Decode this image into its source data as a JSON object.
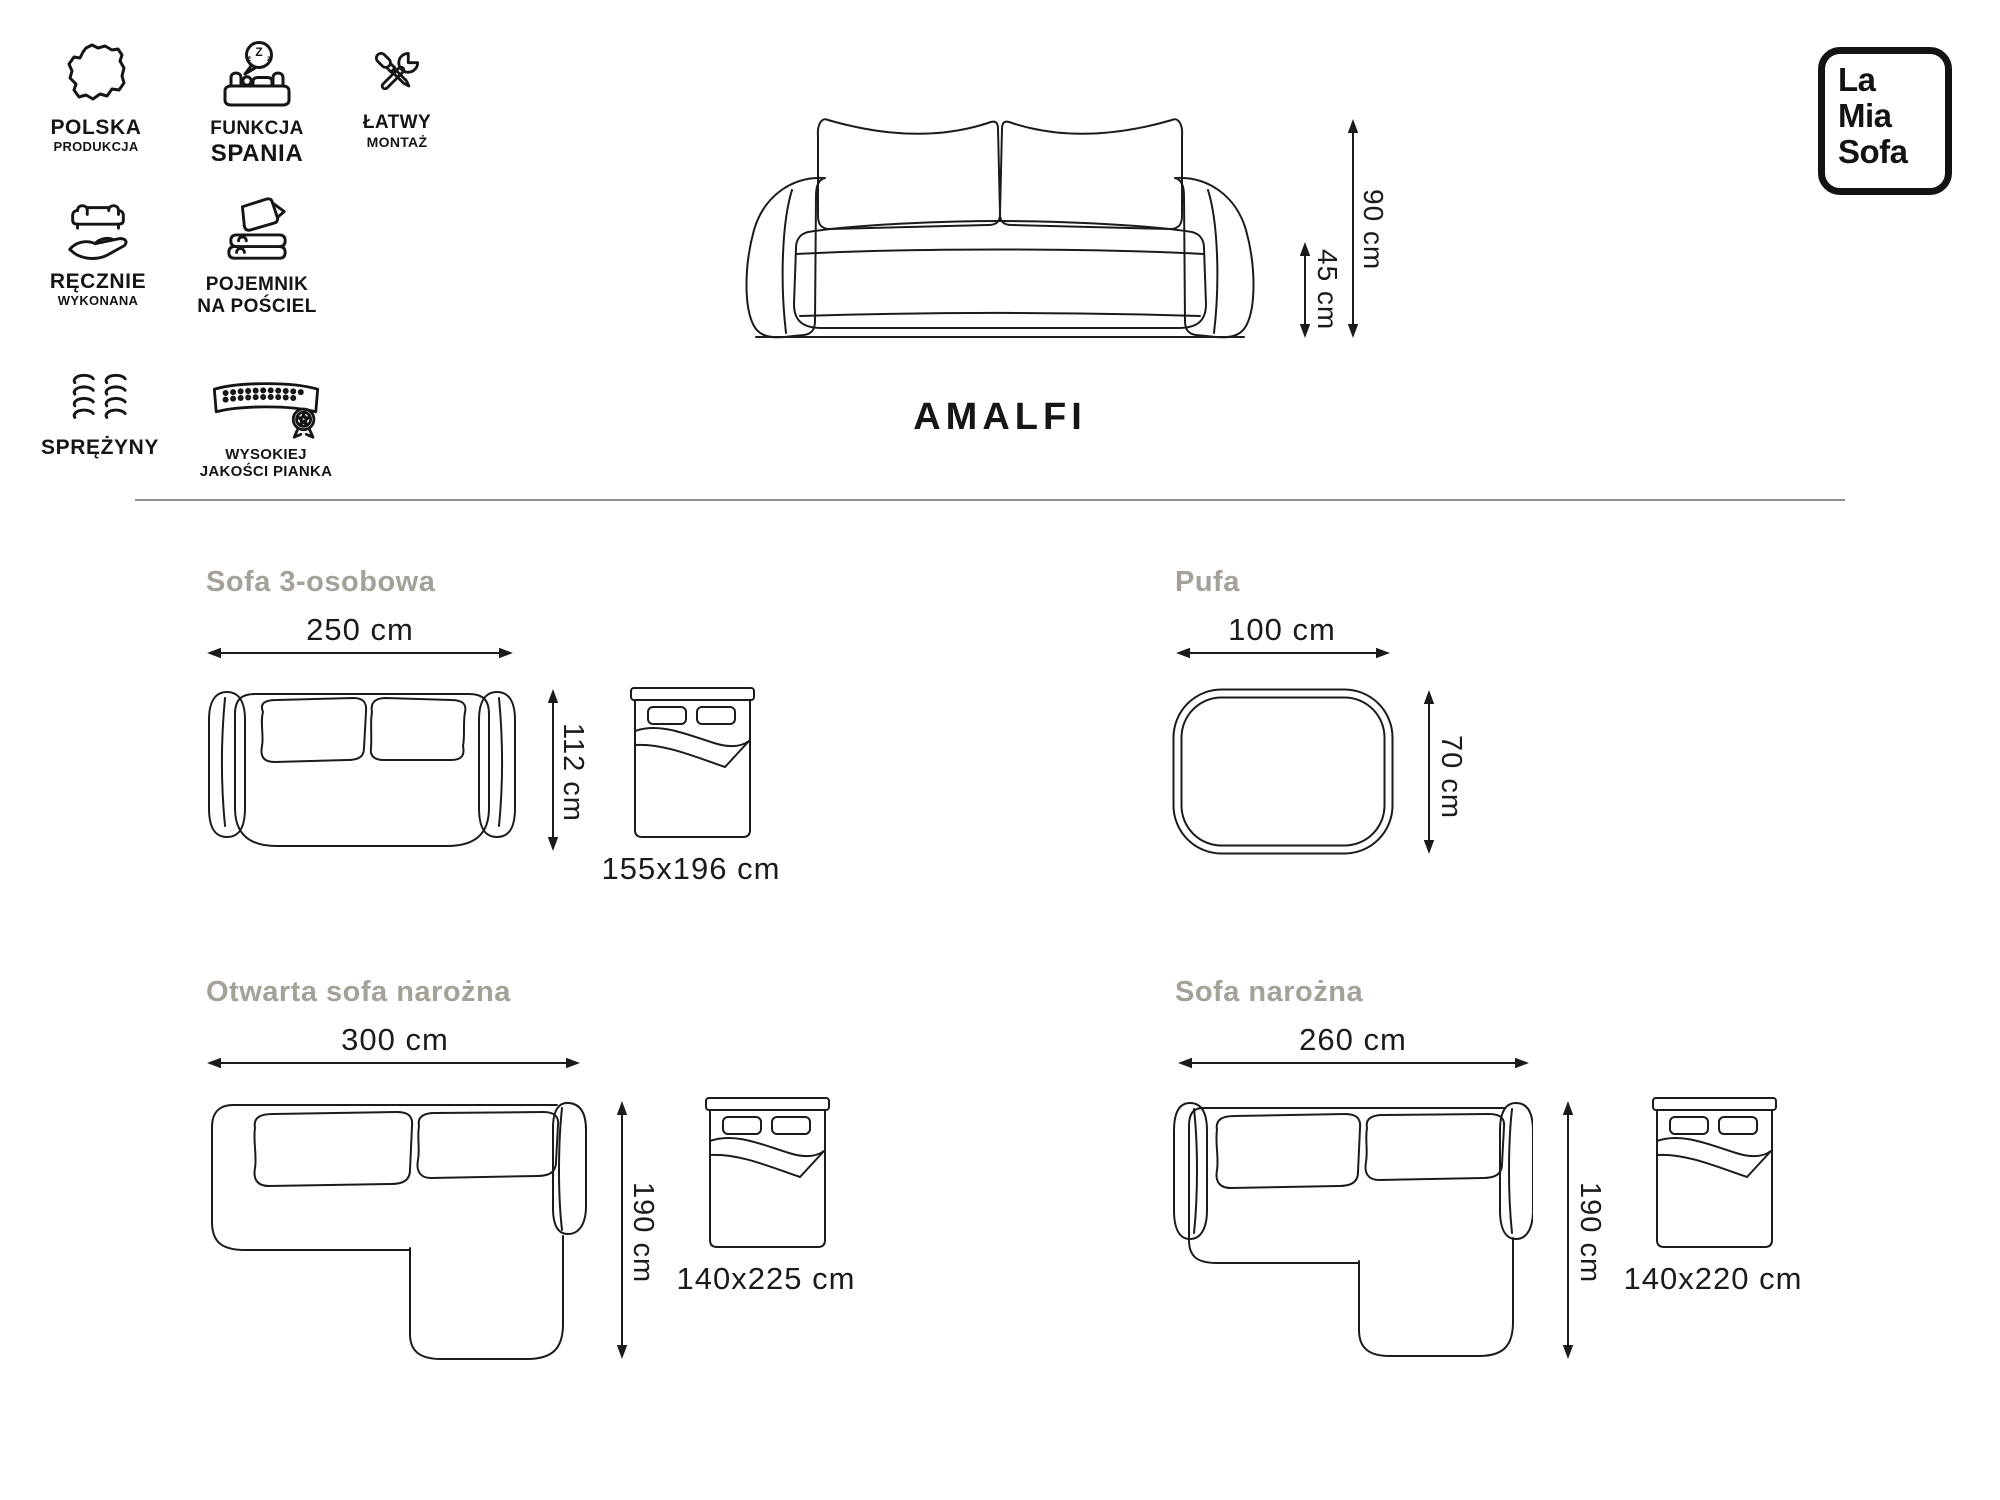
{
  "logo": {
    "line1": "La",
    "line2": "Mia",
    "line3": "Sofa"
  },
  "product": {
    "name": "AMALFI"
  },
  "hero": {
    "total_height": "90 cm",
    "seat_height": "45 cm"
  },
  "badges": {
    "polska": {
      "line1": "POLSKA",
      "line2": "PRODUKCJA"
    },
    "spanie": {
      "line1": "FUNKCJA",
      "line2": "SPANIA",
      "zzz1": "Z",
      "zzz2": "z",
      "zzz3": "z"
    },
    "montaz": {
      "line1": "ŁATWY",
      "line2": "MONTAŻ"
    },
    "recznie": {
      "line1": "RĘCZNIE",
      "line2": "WYKONANA"
    },
    "pojemnik": {
      "line1": "POJEMNIK",
      "line2": "NA POŚCIEL"
    },
    "sprezyny": {
      "line1": "SPRĘŻYNY"
    },
    "pianka": {
      "line1": "WYSOKIEJ",
      "line2": "JAKOŚCI PIANKA"
    }
  },
  "sections": {
    "sofa3": {
      "title": "Sofa 3-osobowa",
      "width": "250 cm",
      "depth": "112 cm",
      "bed": "155x196 cm"
    },
    "pufa": {
      "title": "Pufa",
      "width": "100 cm",
      "depth": "70 cm"
    },
    "otwarta": {
      "title": "Otwarta sofa narożna",
      "width": "300 cm",
      "depth": "190 cm",
      "bed": "140x225 cm"
    },
    "narozna": {
      "title": "Sofa narożna",
      "width": "260 cm",
      "depth": "190 cm",
      "bed": "140x220 cm"
    }
  },
  "colors": {
    "line": "#1b1b1b",
    "muted_title": "#a5a199",
    "divider": "#8f8f8f",
    "background": "#ffffff"
  }
}
